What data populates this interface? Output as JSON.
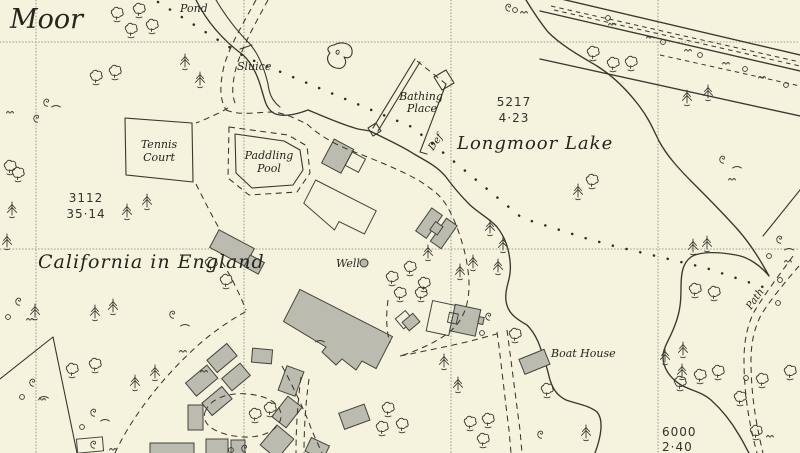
{
  "map": {
    "labels": {
      "moor": "Moor",
      "pond": "Pond",
      "sluice": "Sluice",
      "bathing": [
        "Bathing",
        "Place"
      ],
      "lake_parcel": [
        "5217",
        "4·23"
      ],
      "def": "Def",
      "lake_name": "Longmoor Lake",
      "tennis": [
        "Tennis",
        "Court"
      ],
      "paddling": [
        "Paddling",
        "Pool"
      ],
      "moor_parcel": [
        "3112",
        "35·14"
      ],
      "california": "California in England",
      "well": "Well",
      "boat_house": "Boat House",
      "se_parcel": [
        "6000",
        "2·40"
      ],
      "path": "Path"
    },
    "colors": {
      "background": "#f5f2de",
      "ink": "#3a382e",
      "building_fill": "#bcbbb0",
      "building_outline": "#45443c",
      "grid": "#86836f",
      "text": "#26241d"
    },
    "symbols": {
      "deciduous": [
        [
          117,
          14
        ],
        [
          139,
          10
        ],
        [
          152,
          26
        ],
        [
          131,
          30
        ],
        [
          96,
          77
        ],
        [
          115,
          72
        ],
        [
          10,
          167
        ],
        [
          18,
          174
        ],
        [
          211,
          264
        ],
        [
          226,
          281
        ],
        [
          72,
          370
        ],
        [
          95,
          365
        ],
        [
          255,
          415
        ],
        [
          270,
          409
        ],
        [
          388,
          409
        ],
        [
          382,
          428
        ],
        [
          402,
          425
        ],
        [
          470,
          423
        ],
        [
          488,
          420
        ],
        [
          483,
          440
        ],
        [
          392,
          278
        ],
        [
          410,
          268
        ],
        [
          424,
          284
        ],
        [
          400,
          294
        ],
        [
          421,
          294
        ],
        [
          592,
          181
        ],
        [
          593,
          53
        ],
        [
          613,
          64
        ],
        [
          631,
          63
        ],
        [
          680,
          383
        ],
        [
          700,
          376
        ],
        [
          718,
          372
        ],
        [
          740,
          398
        ],
        [
          762,
          380
        ],
        [
          756,
          432
        ],
        [
          790,
          372
        ],
        [
          515,
          335
        ],
        [
          547,
          390
        ],
        [
          695,
          290
        ],
        [
          714,
          293
        ]
      ],
      "conifer": [
        [
          185,
          62
        ],
        [
          200,
          80
        ],
        [
          12,
          210
        ],
        [
          7,
          242
        ],
        [
          127,
          212
        ],
        [
          147,
          202
        ],
        [
          35,
          312
        ],
        [
          95,
          313
        ],
        [
          113,
          307
        ],
        [
          135,
          383
        ],
        [
          155,
          373
        ],
        [
          428,
          253
        ],
        [
          460,
          272
        ],
        [
          473,
          263
        ],
        [
          498,
          267
        ],
        [
          503,
          245
        ],
        [
          490,
          228
        ],
        [
          578,
          192
        ],
        [
          665,
          357
        ],
        [
          683,
          350
        ],
        [
          682,
          372
        ],
        [
          586,
          433
        ],
        [
          693,
          247
        ],
        [
          707,
          244
        ],
        [
          687,
          98
        ],
        [
          708,
          93
        ],
        [
          444,
          362
        ],
        [
          458,
          385
        ]
      ],
      "bush": [
        [
          8,
          317
        ],
        [
          22,
          397
        ],
        [
          82,
          427
        ],
        [
          608,
          18
        ],
        [
          663,
          42
        ],
        [
          700,
          55
        ],
        [
          745,
          69
        ],
        [
          786,
          85
        ],
        [
          769,
          256
        ],
        [
          482,
          333
        ],
        [
          515,
          10
        ],
        [
          231,
          450
        ]
      ],
      "tuft": [
        [
          30,
          320
        ],
        [
          42,
          400
        ],
        [
          113,
          450
        ],
        [
          183,
          352
        ],
        [
          612,
          25
        ],
        [
          650,
          38
        ],
        [
          688,
          51
        ],
        [
          726,
          64
        ],
        [
          762,
          78
        ],
        [
          732,
          180
        ],
        [
          788,
          262
        ],
        [
          770,
          437
        ],
        [
          524,
          13
        ],
        [
          10,
          113
        ],
        [
          204,
          372
        ]
      ],
      "scrub": [
        [
          46,
          103
        ],
        [
          36,
          119
        ],
        [
          18,
          302
        ],
        [
          32,
          383
        ],
        [
          93,
          413
        ],
        [
          93,
          445
        ],
        [
          172,
          315
        ],
        [
          488,
          317
        ],
        [
          508,
          8
        ],
        [
          722,
          160
        ],
        [
          779,
          240
        ],
        [
          540,
          435
        ],
        [
          244,
          449
        ]
      ],
      "arc": [
        [
          56,
          107
        ],
        [
          185,
          326
        ],
        [
          105,
          421
        ],
        [
          737,
          168
        ],
        [
          789,
          250
        ],
        [
          44,
          398
        ],
        [
          320,
          342
        ]
      ]
    }
  }
}
